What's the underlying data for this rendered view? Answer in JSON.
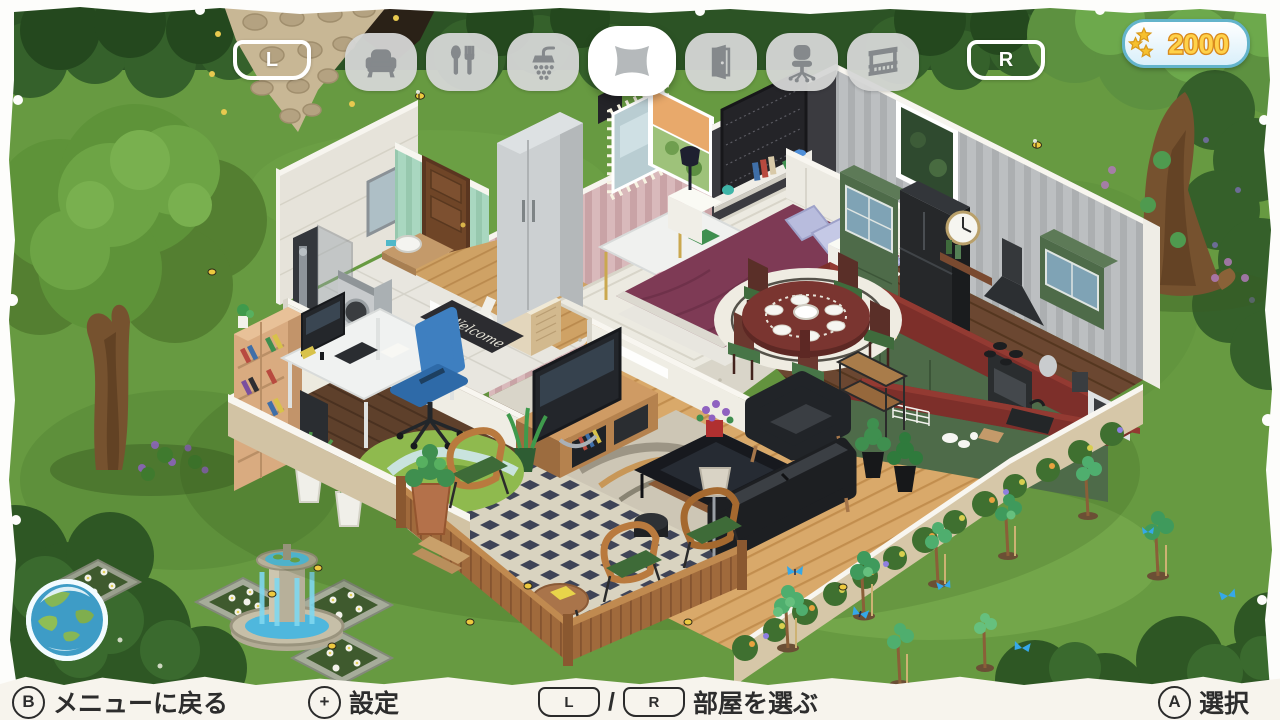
{
  "hud": {
    "l_button": "L",
    "r_button": "R",
    "currency": {
      "amount": "2000",
      "icon": "stars-icon"
    },
    "room_categories": [
      {
        "id": "living-room",
        "icon": "armchair-icon",
        "selected": false
      },
      {
        "id": "dining-room",
        "icon": "cutlery-icon",
        "selected": false
      },
      {
        "id": "bathroom",
        "icon": "shower-icon",
        "selected": false
      },
      {
        "id": "bedroom",
        "icon": "pillow-icon",
        "selected": true
      },
      {
        "id": "hallway",
        "icon": "door-icon",
        "selected": false
      },
      {
        "id": "office",
        "icon": "office-chair-icon",
        "selected": false
      },
      {
        "id": "patio",
        "icon": "porch-icon",
        "selected": false
      }
    ],
    "map_button_icon": "globe-icon"
  },
  "bottom_bar": {
    "back": {
      "button": "B",
      "label": "メニューに戻る"
    },
    "settings": {
      "button": "+",
      "label": "設定"
    },
    "room_select": {
      "l": "L",
      "separator": "/",
      "r": "R",
      "label": "部屋を選ぶ"
    },
    "select": {
      "button": "A",
      "label": "選択"
    }
  },
  "scene": {
    "doormat_text": "Welcome",
    "rooms": [
      "bathroom",
      "hallway",
      "bedroom",
      "kitchen-dining",
      "living-room",
      "office",
      "patio",
      "garden"
    ],
    "colors": {
      "grass": "#679a41",
      "accent_gold": "#ffd24a",
      "badge_border": "#63b4cb",
      "living_floor": "#d9a96a",
      "bed_cover": "#7e3a55",
      "kitchen_cabinet": "#4e6b49",
      "countertop": "#7d2f2a",
      "patio_dark": "#3f4457",
      "mint_wall": "#a9d7c0",
      "pink_wall": "#d9b9bb"
    }
  }
}
